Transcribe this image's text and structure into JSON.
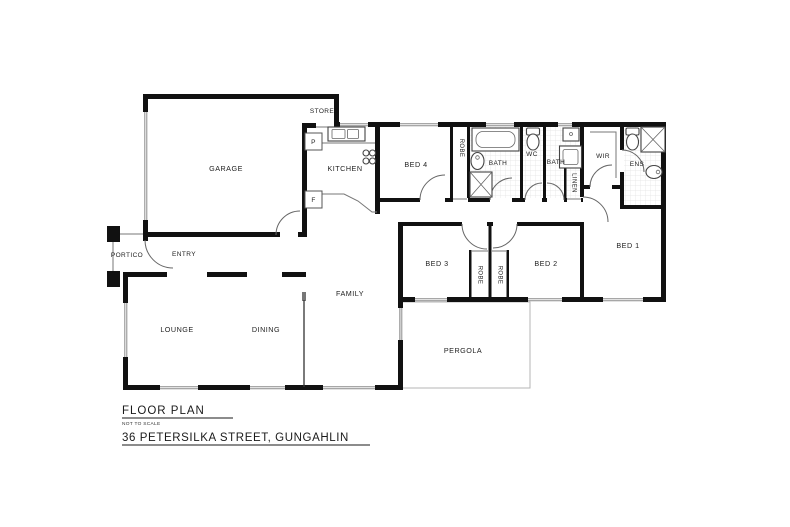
{
  "title_block": {
    "title": "FLOOR PLAN",
    "subtitle": "NOT TO SCALE",
    "address": "36 PETERSILKA STREET, GUNGAHLIN"
  },
  "rooms": {
    "garage": "GARAGE",
    "store": "STORE",
    "kitchen": "KITCHEN",
    "pantry": "P",
    "fridge": "F",
    "bed4": "BED 4",
    "robe_bed4": "ROBE",
    "bath_1": "BATH",
    "wc": "WC",
    "bath_2": "BATH",
    "linen": "LINEN",
    "wir": "WIR",
    "ens": "ENS",
    "bed1": "BED 1",
    "bed2": "BED 2",
    "bed3": "BED 3",
    "robe_bed3": "ROBE",
    "robe_bed2": "ROBE",
    "family": "FAMILY",
    "lounge": "LOUNGE",
    "dining": "DINING",
    "pergola": "PERGOLA",
    "portico": "PORTICO",
    "entry": "ENTRY"
  },
  "colors": {
    "wall": "#111111",
    "label": "#222222",
    "thin_line": "#777777",
    "background": "#ffffff"
  }
}
